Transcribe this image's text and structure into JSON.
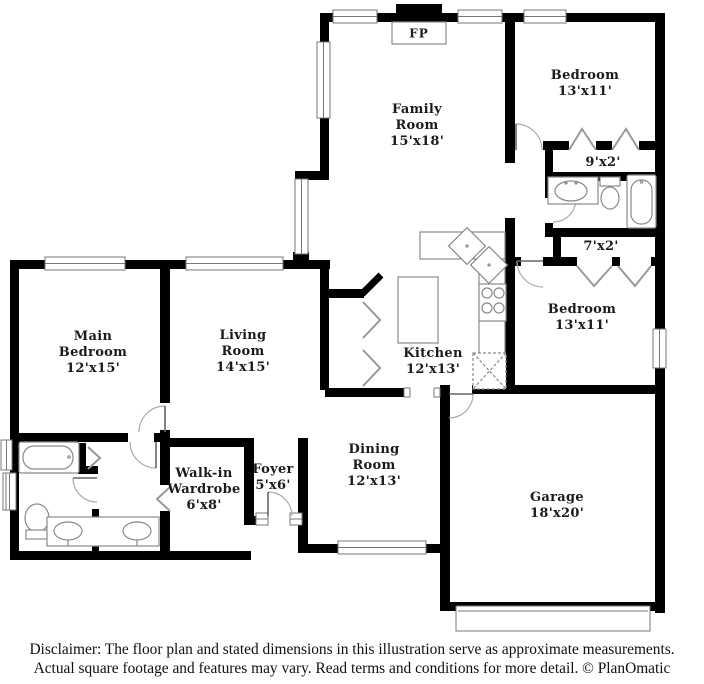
{
  "floorplan": {
    "fireplace_label": "FP",
    "rooms": [
      {
        "id": "family-room",
        "label": "Family\nRoom\n15'x18'"
      },
      {
        "id": "bedroom-top",
        "label": "Bedroom\n13'x11'"
      },
      {
        "id": "closet-9x2",
        "label": "9'x2'"
      },
      {
        "id": "closet-7x2",
        "label": "7'x2'"
      },
      {
        "id": "bedroom-right",
        "label": "Bedroom\n13'x11'"
      },
      {
        "id": "main-bedroom",
        "label": "Main\nBedroom\n12'x15'"
      },
      {
        "id": "living-room",
        "label": "Living\nRoom\n14'x15'"
      },
      {
        "id": "kitchen",
        "label": "Kitchen\n12'x13'"
      },
      {
        "id": "walk-in-wardrobe",
        "label": "Walk-in\nWardrobe\n6'x8'"
      },
      {
        "id": "foyer",
        "label": "Foyer\n5'x6'"
      },
      {
        "id": "dining-room",
        "label": "Dining\nRoom\n12'x13'"
      },
      {
        "id": "garage",
        "label": "Garage\n18'x20'"
      }
    ],
    "icons": [
      "bathtub-icon",
      "toilet-icon",
      "sink-icon",
      "double-sink-icon",
      "corner-sink-icon",
      "stove-icon",
      "kitchen-island-icon",
      "refrigerator-icon",
      "fireplace-icon",
      "window-icon",
      "door-arc-icon",
      "bifold-door-icon",
      "garage-door-icon"
    ],
    "colors": {
      "wall": "#000000",
      "fixture_outline": "#8a8a8a",
      "text": "#1b1b1b",
      "background": "#ffffff"
    }
  },
  "disclaimer": {
    "line1": "Disclaimer: The floor plan and stated dimensions in this illustration serve as approximate measurements.",
    "line2": "Actual square footage and features may vary. Read terms and conditions for more detail. © PlanOmatic"
  }
}
